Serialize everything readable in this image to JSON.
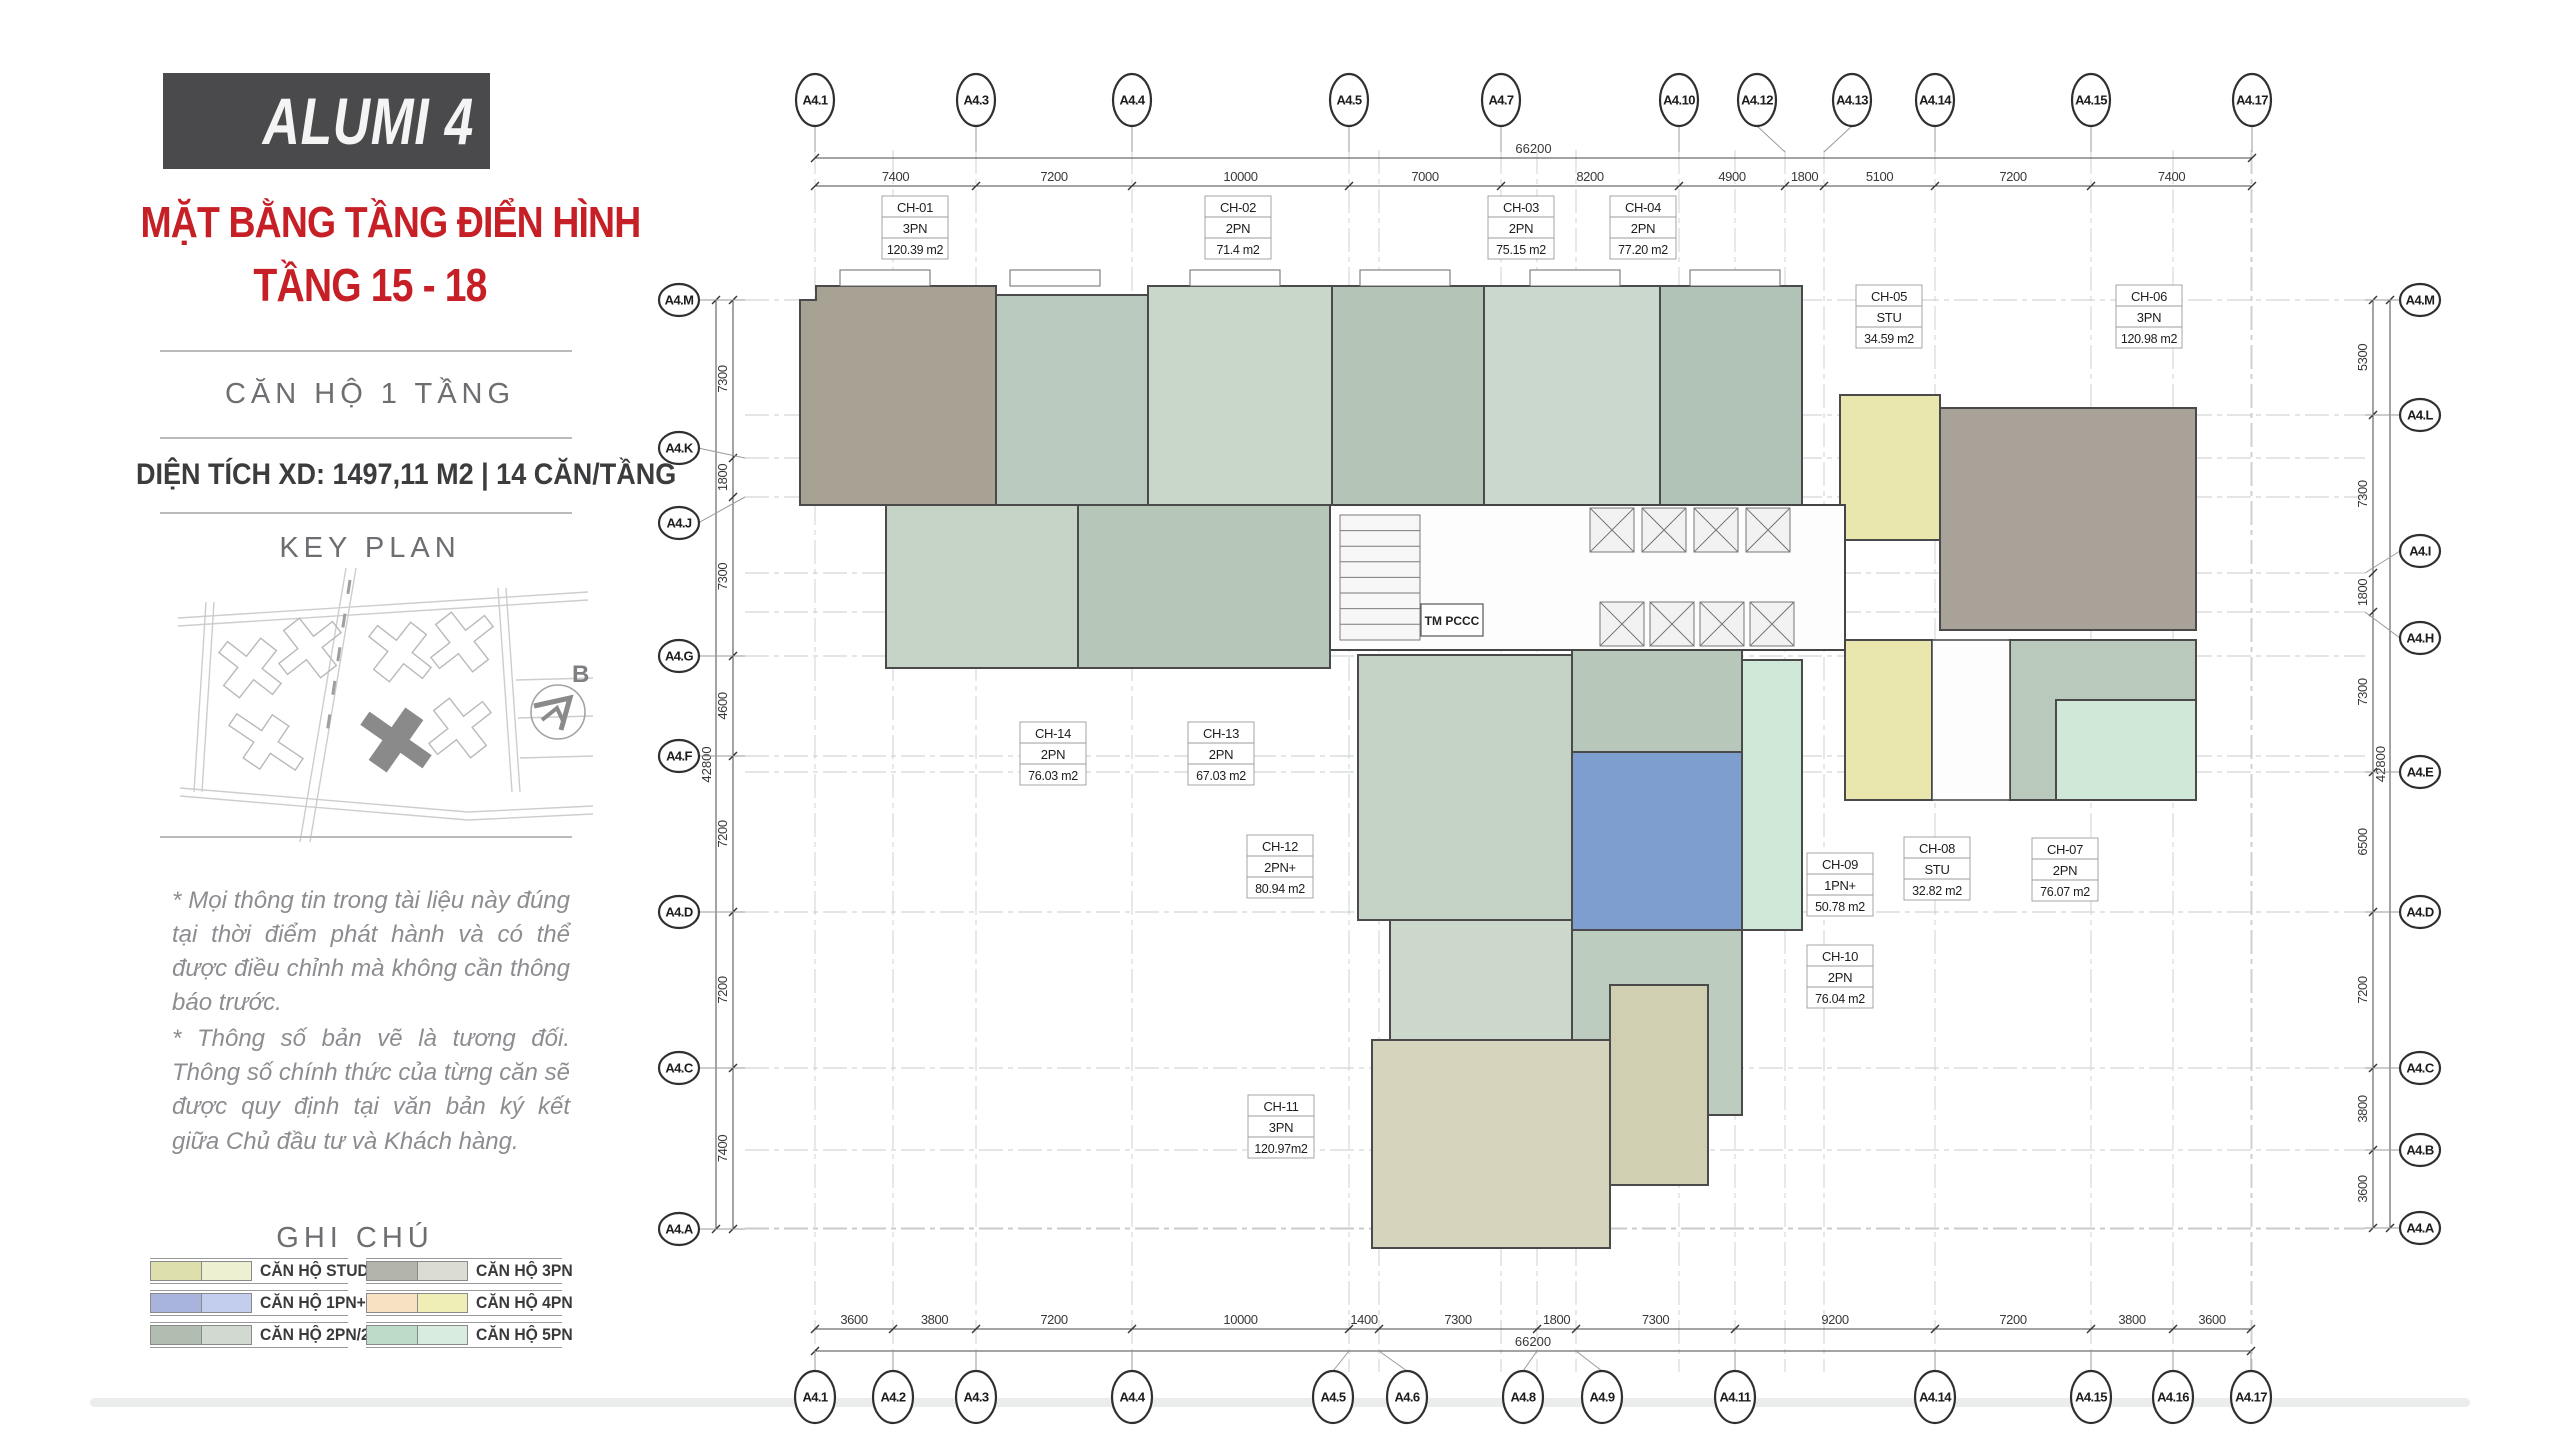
{
  "sidebar": {
    "title": "ALUMI 4",
    "subtitle_line1": "MẶT BẰNG TẦNG ĐIỂN HÌNH",
    "subtitle_line2": "TẦNG 15 - 18",
    "unit_type_heading": "CĂN HỘ 1 TẦNG",
    "area_line": "DIỆN TÍCH XD: 1497,11 M2  |  14 CĂN/TẦNG",
    "key_plan_heading": "KEY PLAN",
    "notes1": "* Mọi thông tin trong tài liệu này đúng tại thời điểm phát hành và có thể được điều chỉnh mà không cần thông báo trước.",
    "notes2": "* Thông số bản vẽ là tương đối. Thông số chính thức của từng căn sẽ được quy định tại văn bản ký kết giữa Chủ đầu tư và Khách hàng.",
    "accent_red": "#c61f26",
    "title_box_gray": "#4a4a4c"
  },
  "compass": {
    "label": "B"
  },
  "legend": {
    "title": "GHI CHÚ",
    "col1": [
      {
        "label": "CĂN HỘ STUDIO",
        "dark": "#dde0ad",
        "light": "#eef0d2"
      },
      {
        "label": "CĂN HỘ 1PN+",
        "dark": "#a8b4dc",
        "light": "#c3cdee"
      },
      {
        "label": "CĂN HỘ 2PN/2PN+",
        "dark": "#b2bdb1",
        "light": "#d2d9d1"
      }
    ],
    "col2": [
      {
        "label": "CĂN HỘ 3PN",
        "dark": "#b3b5ab",
        "light": "#dbddd3"
      },
      {
        "label": "CĂN HỘ 4PN",
        "dark": "#f6e2c2",
        "light": "#eeeeb6"
      },
      {
        "label": "CĂN HỘ 5PN",
        "dark": "#bcdbc9",
        "light": "#d8eddf"
      }
    ]
  },
  "grid": {
    "top_labels": [
      "A4.1",
      "A4.3",
      "A4.4",
      "A4.5",
      "A4.7",
      "A4.10",
      "A4.12",
      "A4.13",
      "A4.14",
      "A4.15",
      "A4.17"
    ],
    "top_dims": [
      "7400",
      "7200",
      "10000",
      "7000",
      "8200",
      "4900",
      "1800",
      "5100",
      "7200",
      "7400"
    ],
    "top_overall": "66200",
    "bottom_labels": [
      "A4.1",
      "A4.2",
      "A4.3",
      "A4.4",
      "A4.5",
      "A4.6",
      "A4.8",
      "A4.9",
      "A4.11",
      "A4.14",
      "A4.15",
      "A4.16",
      "A4.17"
    ],
    "bottom_dims": [
      "3600",
      "3800",
      "7200",
      "10000",
      "1400",
      "7300",
      "1800",
      "7300",
      "9200",
      "7200",
      "3800",
      "3600"
    ],
    "bottom_overall": "66200",
    "left_labels": [
      "A4.M",
      "A4.K",
      "A4.J",
      "A4.G",
      "A4.F",
      "A4.D",
      "A4.C",
      "A4.A"
    ],
    "left_dims": [
      "7300",
      "1800",
      "7300",
      "4600",
      "7200",
      "7200",
      "7400"
    ],
    "left_overall": "42800",
    "right_labels": [
      "A4.M",
      "A4.L",
      "A4.I",
      "A4.H",
      "A4.E",
      "A4.D",
      "A4.C",
      "A4.B",
      "A4.A"
    ],
    "right_dims": [
      "5300",
      "7300",
      "1800",
      "7300",
      "6500",
      "7200",
      "3800",
      "3600"
    ],
    "right_overall": "42800"
  },
  "core": {
    "label": "TM PCCC"
  },
  "units": [
    {
      "id": "CH-01",
      "type": "3PN",
      "area": "120.39 m2"
    },
    {
      "id": "CH-02",
      "type": "2PN",
      "area": "71.4 m2"
    },
    {
      "id": "CH-03",
      "type": "2PN",
      "area": "75.15 m2"
    },
    {
      "id": "CH-04",
      "type": "2PN",
      "area": "77.20 m2"
    },
    {
      "id": "CH-05",
      "type": "STU",
      "area": "34.59 m2"
    },
    {
      "id": "CH-06",
      "type": "3PN",
      "area": "120.98 m2"
    },
    {
      "id": "CH-07",
      "type": "2PN",
      "area": "76.07 m2"
    },
    {
      "id": "CH-08",
      "type": "STU",
      "area": "32.82 m2"
    },
    {
      "id": "CH-09",
      "type": "1PN+",
      "area": "50.78 m2"
    },
    {
      "id": "CH-10",
      "type": "2PN",
      "area": "76.04 m2"
    },
    {
      "id": "CH-11",
      "type": "3PN",
      "area": "120.97m2"
    },
    {
      "id": "CH-12",
      "type": "2PN+",
      "area": "80.94 m2"
    },
    {
      "id": "CH-13",
      "type": "2PN",
      "area": "67.03 m2"
    },
    {
      "id": "CH-14",
      "type": "2PN",
      "area": "76.03 m2"
    }
  ]
}
